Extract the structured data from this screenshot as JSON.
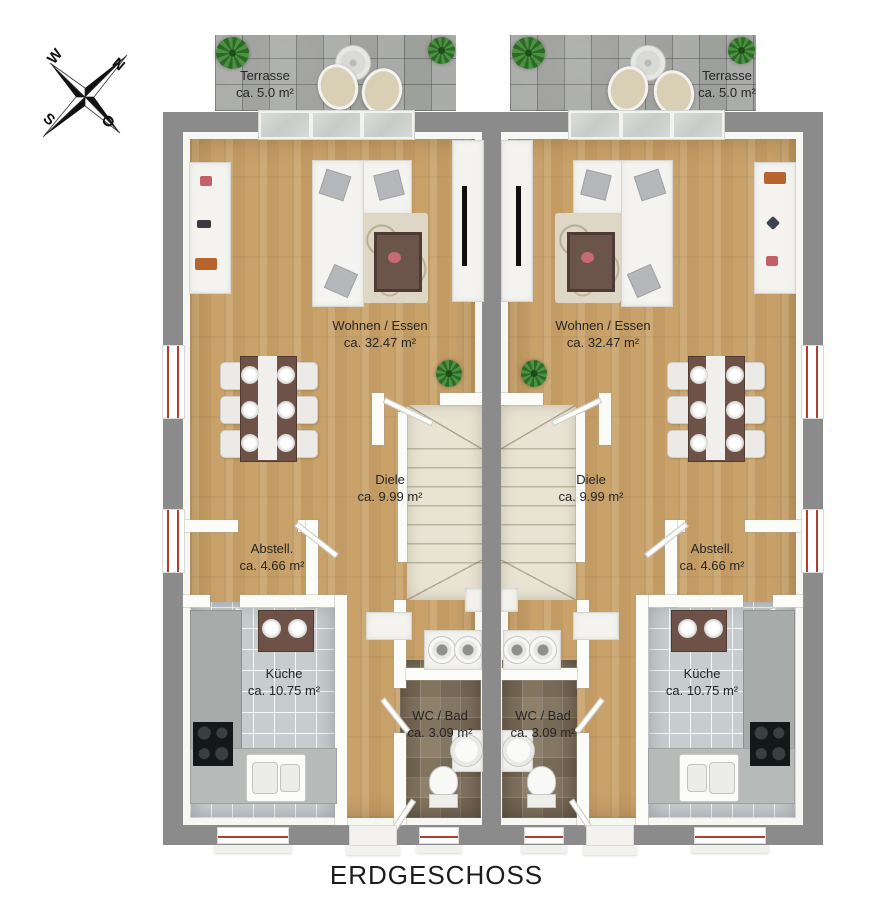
{
  "title": "ERDGESCHOSS",
  "compass": {
    "n": "N",
    "o": "O",
    "s": "S",
    "w": "W"
  },
  "units": [
    {
      "side": "left",
      "terrasse": {
        "name": "Terrasse",
        "area": "ca. 5.0 m²"
      },
      "wohnen_essen": {
        "name": "Wohnen / Essen",
        "area": "ca. 32.47 m²"
      },
      "diele": {
        "name": "Diele",
        "area": "ca. 9.99 m²"
      },
      "abstell": {
        "name": "Abstell.",
        "area": "ca. 4.66 m²"
      },
      "kueche": {
        "name": "Küche",
        "area": "ca. 10.75 m²"
      },
      "wc_bad": {
        "name": "WC / Bad",
        "area": "ca. 3.09 m²"
      }
    },
    {
      "side": "right",
      "terrasse": {
        "name": "Terrasse",
        "area": "ca. 5.0 m²"
      },
      "wohnen_essen": {
        "name": "Wohnen / Essen",
        "area": "ca. 32.47 m²"
      },
      "diele": {
        "name": "Diele",
        "area": "ca. 9.99 m²"
      },
      "abstell": {
        "name": "Abstell.",
        "area": "ca. 4.66 m²"
      },
      "kueche": {
        "name": "Küche",
        "area": "ca. 10.75 m²"
      },
      "wc_bad": {
        "name": "WC / Bad",
        "area": "ca. 3.09 m²"
      }
    }
  ],
  "colors": {
    "outer_wall": "#8b8b8b",
    "wood_floor": "#c9a26a",
    "window_accent": "#b23b32",
    "stair": "#e9e3d3"
  }
}
